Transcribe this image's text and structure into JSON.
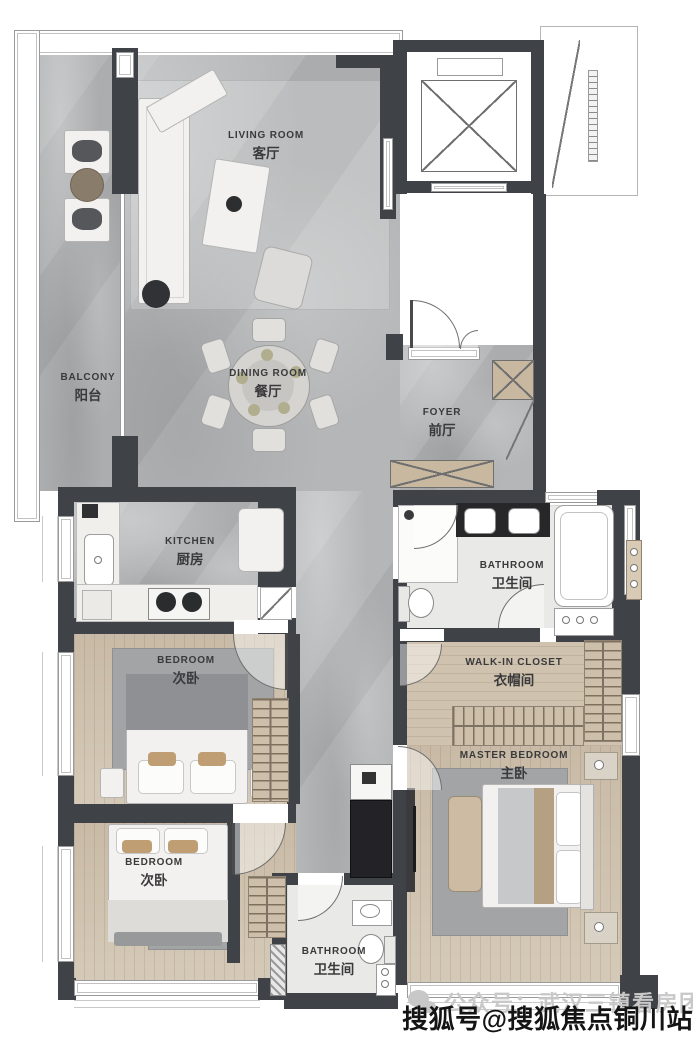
{
  "plan": {
    "rooms": {
      "living": {
        "en": "LIVING ROOM",
        "cn": "客厅"
      },
      "balcony": {
        "en": "BALCONY",
        "cn": "阳台"
      },
      "dining": {
        "en": "DINING ROOM",
        "cn": "餐厅"
      },
      "foyer": {
        "en": "FOYER",
        "cn": "前厅"
      },
      "kitchen": {
        "en": "KITCHEN",
        "cn": "厨房"
      },
      "bathroom_main": {
        "en": "BATHROOM",
        "cn": "卫生间"
      },
      "bedroom_upper": {
        "en": "BEDROOM",
        "cn": "次卧"
      },
      "walk_in_closet": {
        "en": "WALK-IN CLOSET",
        "cn": "衣帽间"
      },
      "master_bedroom": {
        "en": "MASTER BEDROOM",
        "cn": "主卧"
      },
      "bedroom_lower": {
        "en": "BEDROOM",
        "cn": "次卧"
      },
      "bathroom_small": {
        "en": "BATHROOM",
        "cn": "卫生间"
      }
    },
    "watermarks": {
      "wechat_text": "公众号：武汉三镇看房团",
      "sohu_text": "搜狐号@搜狐焦点铜川站"
    },
    "colors": {
      "wall": "#3f4247",
      "floor_stone": "#b4b6b7",
      "floor_wood": "#cfc2ae",
      "floor_tile": "#e9e9e7",
      "cabinet_tan": "#c9b8a0",
      "watermark_dark": "#141414",
      "watermark_light": "#c8c8c8"
    }
  }
}
